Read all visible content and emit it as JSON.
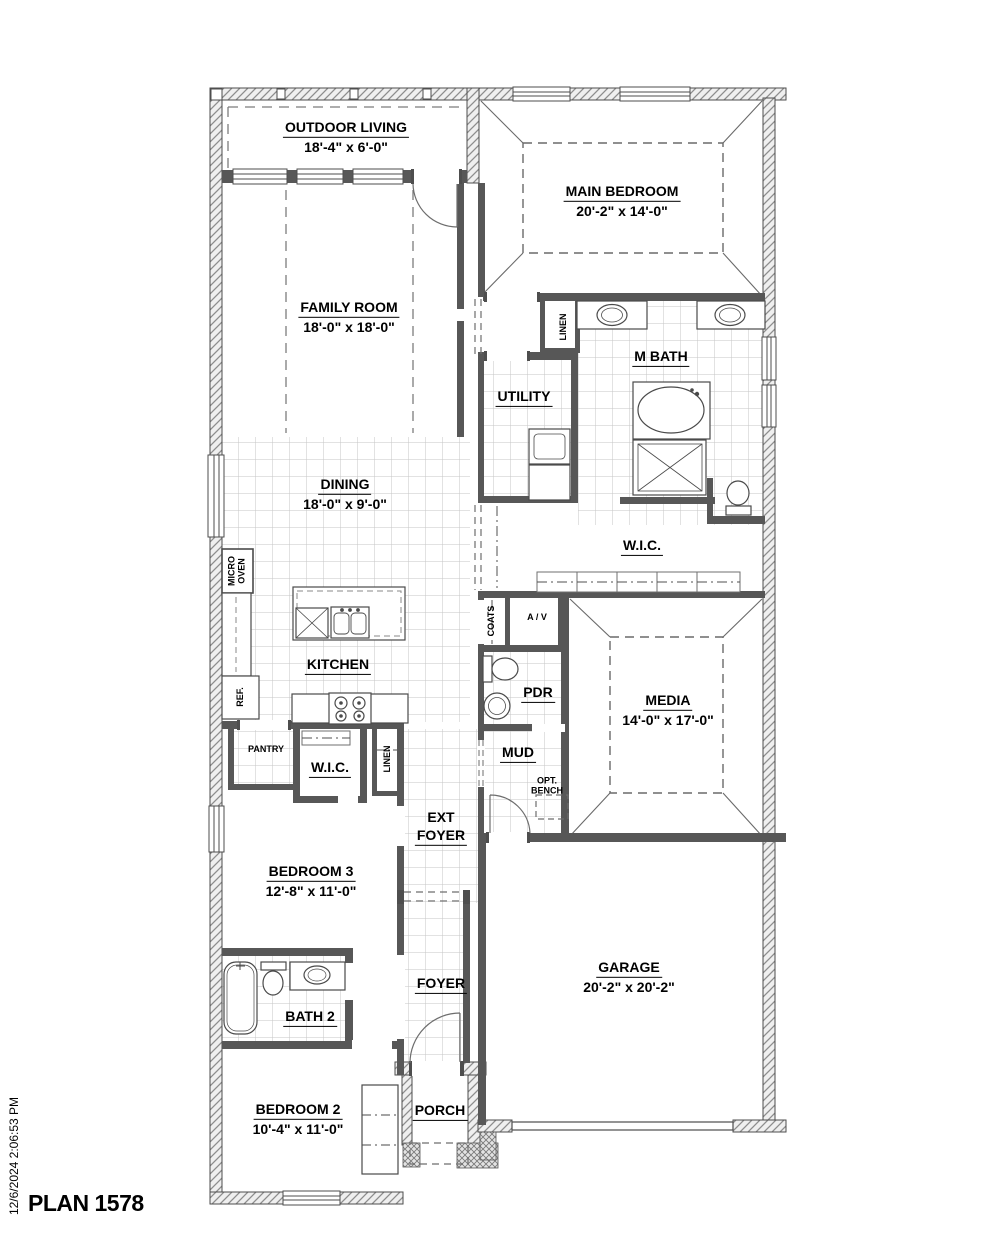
{
  "plan": {
    "title": "PLAN 1578",
    "timestamp": "12/6/2024 2:06:53 PM"
  },
  "rooms": {
    "outdoor_living": {
      "name": "OUTDOOR LIVING",
      "dims": "18'-4\" x 6'-0\""
    },
    "main_bedroom": {
      "name": "MAIN BEDROOM",
      "dims": "20'-2\" x 14'-0\""
    },
    "family_room": {
      "name": "FAMILY ROOM",
      "dims": "18'-0\" x 18'-0\""
    },
    "m_bath": {
      "name": "M BATH"
    },
    "utility": {
      "name": "UTILITY"
    },
    "dining": {
      "name": "DINING",
      "dims": "18'-0\" x 9'-0\""
    },
    "wic_main": {
      "name": "W.I.C."
    },
    "kitchen": {
      "name": "KITCHEN"
    },
    "pdr": {
      "name": "PDR"
    },
    "media": {
      "name": "MEDIA",
      "dims": "14'-0\" x 17'-0\""
    },
    "mud": {
      "name": "MUD"
    },
    "pantry": {
      "name": "PANTRY"
    },
    "wic_bed3": {
      "name": "W.I.C."
    },
    "ext_foyer": {
      "line1": "EXT",
      "line2": "FOYER"
    },
    "bedroom3": {
      "name": "BEDROOM 3",
      "dims": "12'-8\" x 11'-0\""
    },
    "garage": {
      "name": "GARAGE",
      "dims": "20'-2\" x 20'-2\""
    },
    "bath2": {
      "name": "BATH 2"
    },
    "foyer": {
      "name": "FOYER"
    },
    "bedroom2": {
      "name": "BEDROOM 2",
      "dims": "10'-4\" x 11'-0\""
    },
    "porch": {
      "name": "PORCH"
    }
  },
  "closets": {
    "linen_main": "LINEN",
    "linen_hall": "LINEN",
    "coats": "COATS",
    "av": "A / V"
  },
  "appliances": {
    "micro_line1": "MICRO",
    "micro_line2": "OVEN",
    "ref": "REF."
  },
  "options": {
    "opt_bench_line1": "OPT.",
    "opt_bench_line2": "BENCH"
  }
}
